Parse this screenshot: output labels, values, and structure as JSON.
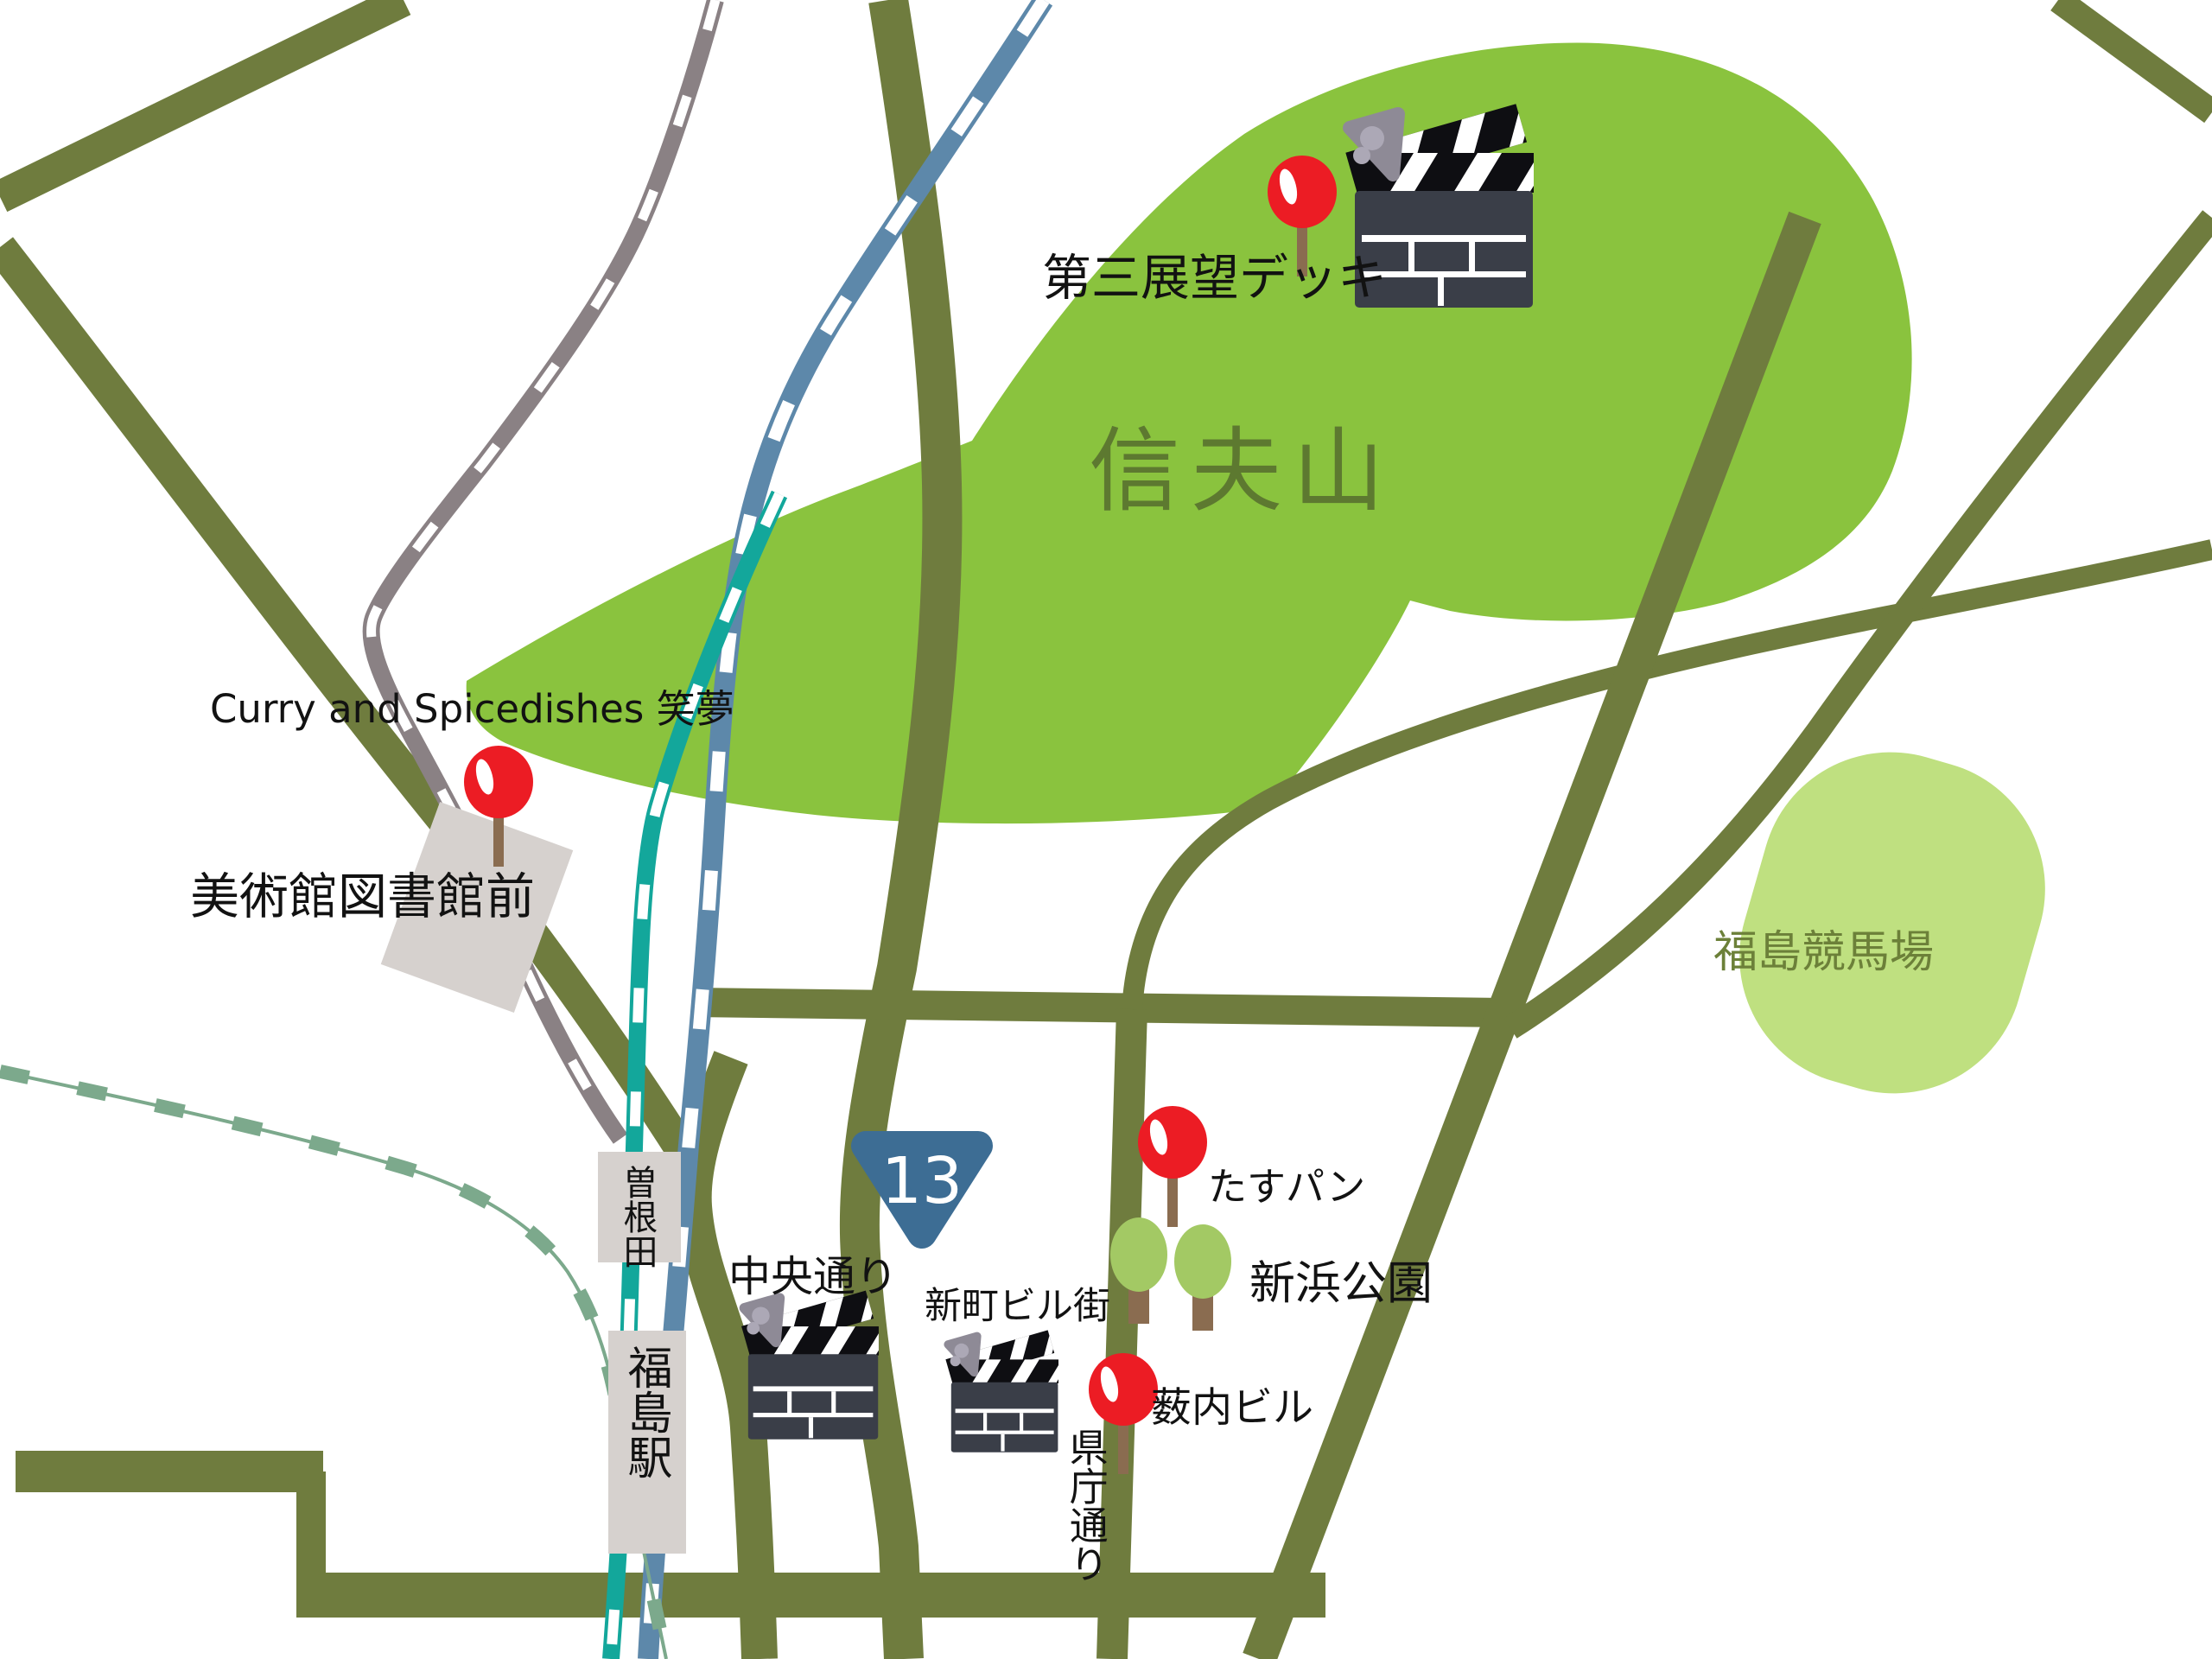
{
  "map": {
    "labels": {
      "observation_deck": "第三展望デッキ",
      "mountain": "信夫山",
      "curry_shop": "Curry and Spicedishes 笑夢",
      "museum_library_station": "美術館図書館前",
      "soneda_station": "曽根田",
      "fukushima_station": "福島駅",
      "route_number": "13",
      "chuo_street": "中央通り",
      "shinmachi_building_street": "新町ビル街",
      "tasu_pan_bakery": "たすパン",
      "shinhama_park": "新浜公園",
      "yabuuchi_building": "薮内ビル",
      "kencho_street": "県庁通り",
      "racecourse": "福島競馬場"
    },
    "colors": {
      "background": "#FFFFFF",
      "mountain_green": "#8AC33E",
      "mountain_text": "#5D7930",
      "racecourse_green": "#BFE080",
      "racecourse_text": "#6C8039",
      "road_olive": "#6F7C3E",
      "rail_gray": "#8A8184",
      "rail_blue": "#5D88AA",
      "rail_teal": "#13A79B",
      "rail_sage_dashed": "#7CA98C",
      "station_box_gray": "#D6D1CE",
      "route_shield_blue": "#3D6D94",
      "pin_red": "#EC1C24",
      "tree_green": "#A3C964",
      "trunk_brown": "#8A6C50",
      "clapperboard_body": "#3A3E48"
    },
    "markers": {
      "red_pins_at": [
        "第三展望デッキ",
        "Curry and Spicedishes 笑夢",
        "たすパン",
        "薮内ビル"
      ],
      "clapperboards_at": [
        "第三展望デッキ",
        "中央通り",
        "新町ビル街"
      ],
      "tree_icons": 2,
      "station_boxes": [
        "美術館図書館前",
        "曽根田",
        "福島駅"
      ]
    }
  }
}
